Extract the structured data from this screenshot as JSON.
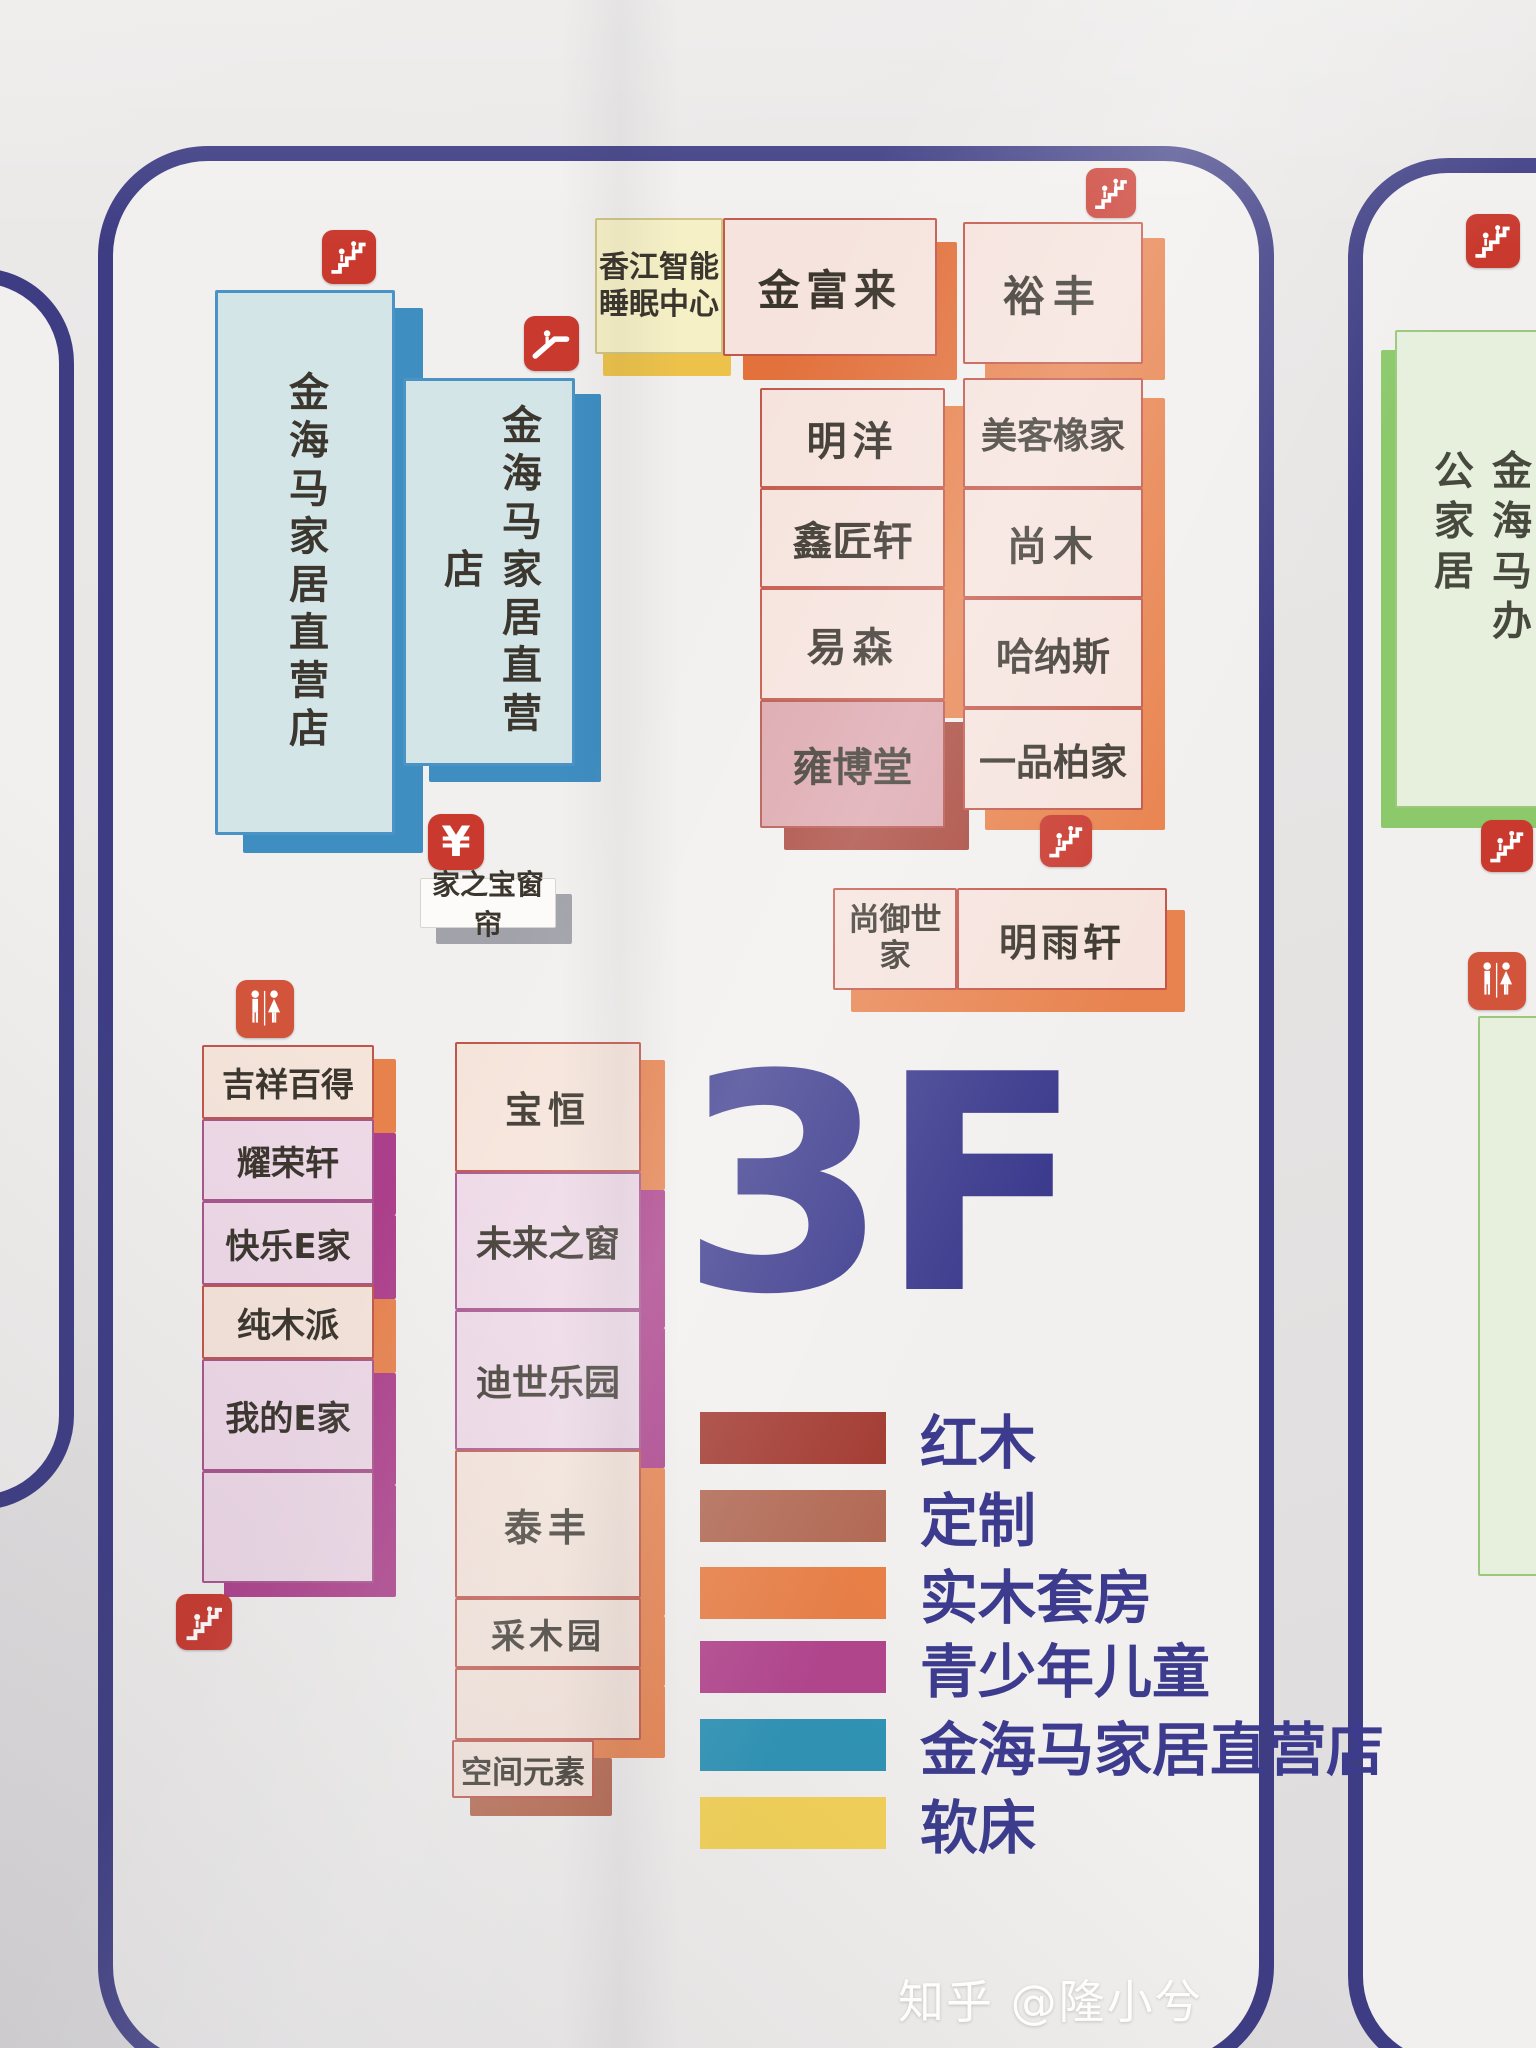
{
  "floor": {
    "label": "3F"
  },
  "watermark": "知乎 @隆小兮",
  "colors": {
    "panel_border": "#3e3d84",
    "floor_text": "#3c3b8e",
    "icon_red": "#c9392e",
    "restroom_orange": "#d2553b",
    "blue_store": "#2f93b5",
    "green_store": "#8cc96b"
  },
  "top_row": {
    "sleep_center": "香江智能睡眠中心",
    "jinfulai": "金富来",
    "yufeng": "裕丰"
  },
  "direct_stores": {
    "left": "金海马家居直营店",
    "right": "金海马家居直营店"
  },
  "mid_column": [
    "明洋",
    "鑫匠轩",
    "易森",
    "雍博堂"
  ],
  "right_column": [
    "美客橡家",
    "尚木",
    "哈纳斯",
    "一品柏家"
  ],
  "shangyu_row": {
    "left": "尚御世家",
    "right": "明雨轩"
  },
  "currency_symbol": "¥",
  "curtain_label": "家之宝窗帘",
  "left_bottom_column": [
    "吉祥百得",
    "耀荣轩",
    "快乐E家",
    "纯木派",
    "我的E家"
  ],
  "mid_bottom_column": [
    "宝恒",
    "未来之窗",
    "迪世乐园",
    "泰丰",
    "采木园"
  ],
  "space_element": "空间元素",
  "office_store": "金海马办公家居",
  "legend": {
    "items": [
      {
        "label": "红木",
        "color": "#a23a31"
      },
      {
        "label": "定制",
        "color": "#b26a55"
      },
      {
        "label": "实木套房",
        "color": "#e87f47"
      },
      {
        "label": "青少年儿童",
        "color": "#b2458d"
      },
      {
        "label": "金海马家居直营店",
        "color": "#2f93b5"
      },
      {
        "label": "软床",
        "color": "#f3d258"
      }
    ]
  },
  "icons": {
    "stairs": "stairs-icon",
    "escalator": "escalator-icon",
    "restroom": "restroom-icon",
    "currency": "yuan-icon"
  }
}
